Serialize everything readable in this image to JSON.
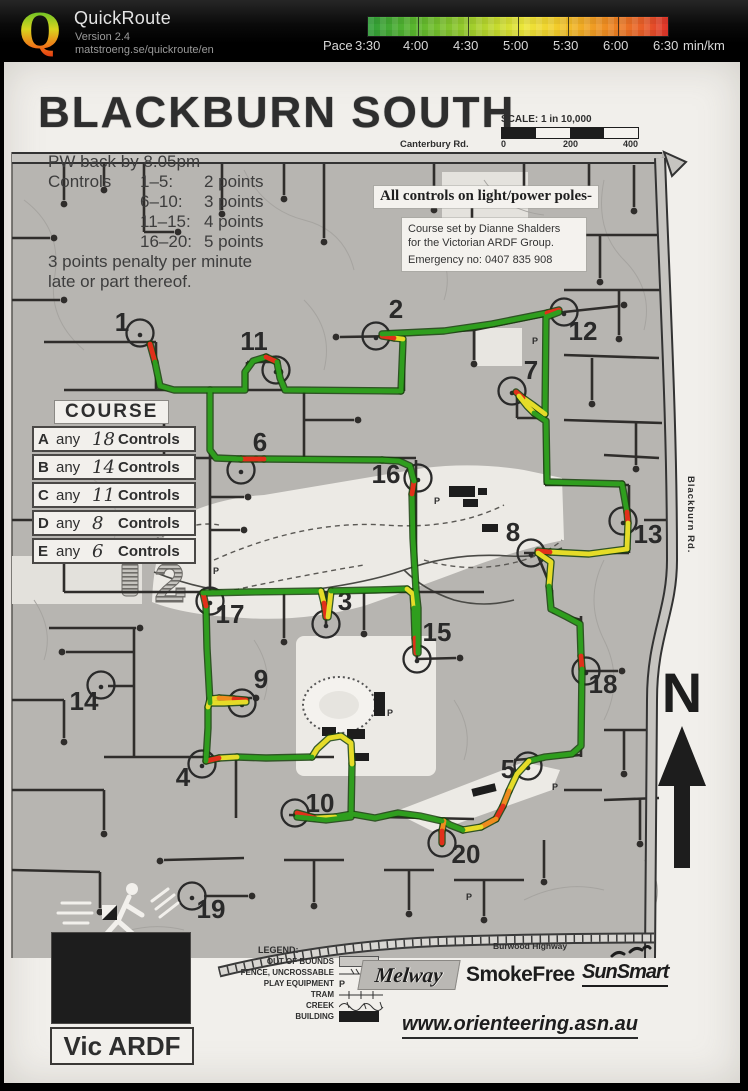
{
  "header": {
    "app_name": "QuickRoute",
    "version": "Version 2.4",
    "url": "matstroeng.se/quickroute/en",
    "logo_letter": "Q",
    "pace": {
      "prefix": "Pace",
      "ticks": [
        "3:30",
        "4:00",
        "4:30",
        "5:00",
        "5:30",
        "6:00",
        "6:30"
      ],
      "unit": "min/km"
    }
  },
  "map": {
    "title": "BLACKBURN SOUTH",
    "info": {
      "back_line": "PW back by 8.05pm",
      "controls_label": "Controls",
      "points_rows": [
        {
          "range": "1–5:",
          "points": "2 points"
        },
        {
          "range": "6–10:",
          "points": "3 points"
        },
        {
          "range": "11–15:",
          "points": "4 points"
        },
        {
          "range": "16–20:",
          "points": "5 points"
        }
      ],
      "penalty_line1": "3 points penalty per minute",
      "penalty_line2": "late or part thereof."
    },
    "scale": {
      "label": "SCALE: 1 in 10,000",
      "ticks": [
        "0",
        "200",
        "400"
      ]
    },
    "roads": {
      "top": "Canterbury Rd.",
      "right": "Blackburn Rd.",
      "bottom": "Burwood Highway"
    },
    "notice": "All controls on light/power poles-",
    "setter": {
      "line1": "Course set by Dianne Shalders",
      "line2": "for the  Victorian ARDF Group.",
      "line3": "Emergency no: 0407 835 908"
    },
    "course": {
      "title": "COURSE",
      "any_word": "any",
      "controls_word": "Controls",
      "rows": [
        {
          "letter": "A",
          "num": "18"
        },
        {
          "letter": "B",
          "num": "14"
        },
        {
          "letter": "C",
          "num": "11"
        },
        {
          "letter": "D",
          "num": "8"
        },
        {
          "letter": "E",
          "num": "6"
        }
      ]
    },
    "north_label": "N",
    "parking_letter": "P",
    "controls": [
      {
        "n": "1",
        "cx": 136,
        "cy": 333,
        "lx": 118,
        "ly": 331
      },
      {
        "n": "2",
        "cx": 372,
        "cy": 336,
        "lx": 392,
        "ly": 318
      },
      {
        "n": "3",
        "cx": 322,
        "cy": 624,
        "lx": 341,
        "ly": 610
      },
      {
        "n": "4",
        "cx": 198,
        "cy": 764,
        "lx": 179,
        "ly": 786
      },
      {
        "n": "5",
        "cx": 524,
        "cy": 766,
        "lx": 504,
        "ly": 778
      },
      {
        "n": "6",
        "cx": 237,
        "cy": 470,
        "lx": 256,
        "ly": 451
      },
      {
        "n": "7",
        "cx": 508,
        "cy": 391,
        "lx": 527,
        "ly": 379
      },
      {
        "n": "8",
        "cx": 527,
        "cy": 553,
        "lx": 509,
        "ly": 541
      },
      {
        "n": "9",
        "cx": 238,
        "cy": 703,
        "lx": 257,
        "ly": 688
      },
      {
        "n": "10",
        "cx": 291,
        "cy": 813,
        "lx": 316,
        "ly": 812
      },
      {
        "n": "11",
        "cx": 272,
        "cy": 370,
        "lx": 250,
        "ly": 350
      },
      {
        "n": "12",
        "cx": 560,
        "cy": 312,
        "lx": 579,
        "ly": 340
      },
      {
        "n": "13",
        "cx": 619,
        "cy": 521,
        "lx": 644,
        "ly": 543
      },
      {
        "n": "14",
        "cx": 97,
        "cy": 685,
        "lx": 80,
        "ly": 710
      },
      {
        "n": "15",
        "cx": 413,
        "cy": 659,
        "lx": 433,
        "ly": 641
      },
      {
        "n": "16",
        "cx": 414,
        "cy": 478,
        "lx": 382,
        "ly": 483
      },
      {
        "n": "17",
        "cx": 206,
        "cy": 601,
        "lx": 226,
        "ly": 623
      },
      {
        "n": "18",
        "cx": 582,
        "cy": 671,
        "lx": 599,
        "ly": 693
      },
      {
        "n": "19",
        "cx": 188,
        "cy": 896,
        "lx": 207,
        "ly": 918
      },
      {
        "n": "20",
        "cx": 438,
        "cy": 843,
        "lx": 462,
        "ly": 863
      }
    ],
    "legend": {
      "title": "LEGEND:",
      "items": [
        {
          "label": "OUT OF BOUNDS",
          "sym": "oob"
        },
        {
          "label": "FENCE, UNCROSSABLE",
          "sym": "fence"
        },
        {
          "label": "PLAY EQUIPMENT",
          "sym": "play"
        },
        {
          "label": "TRAM",
          "sym": "tram"
        },
        {
          "label": "CREEK",
          "sym": "creek"
        },
        {
          "label": "BUILDING",
          "sym": "building"
        }
      ]
    },
    "footer": {
      "melway": "Melway",
      "smokefree": "SmokeFree",
      "sunsmart": "SunSmart",
      "website": "www.orienteering.asn.au",
      "vic_ardf": "Vic ARDF"
    }
  }
}
